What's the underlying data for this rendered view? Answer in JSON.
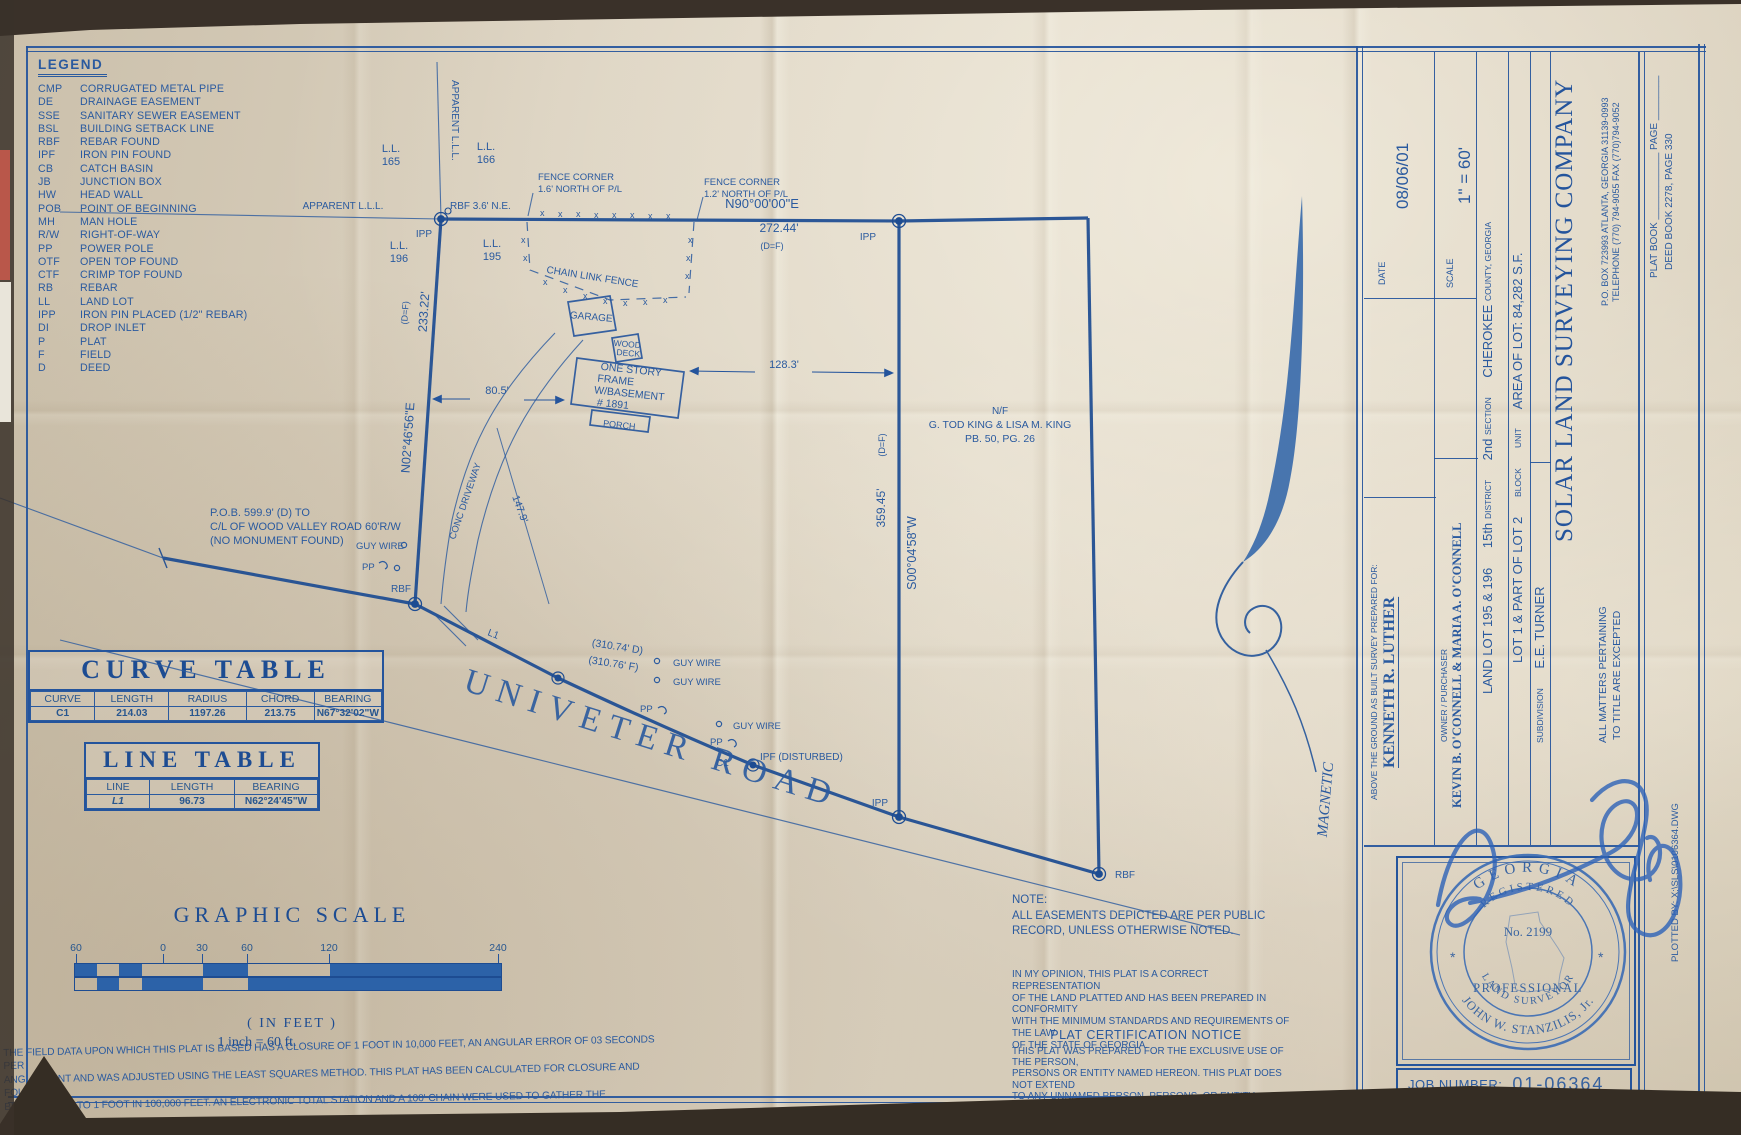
{
  "paper": {
    "ink": "#2a5a9f",
    "ink_dark": "#1d4c92",
    "bg": "#d8cdba"
  },
  "legend": {
    "title": "LEGEND",
    "items": [
      [
        "CMP",
        "CORRUGATED METAL PIPE"
      ],
      [
        "DE",
        "DRAINAGE EASEMENT"
      ],
      [
        "SSE",
        "SANITARY SEWER EASEMENT"
      ],
      [
        "BSL",
        "BUILDING SETBACK LINE"
      ],
      [
        "RBF",
        "REBAR FOUND"
      ],
      [
        "IPF",
        "IRON PIN FOUND"
      ],
      [
        "CB",
        "CATCH BASIN"
      ],
      [
        "JB",
        "JUNCTION BOX"
      ],
      [
        "HW",
        "HEAD WALL"
      ],
      [
        "POB",
        "POINT OF BEGINNING"
      ],
      [
        "MH",
        "MAN HOLE"
      ],
      [
        "R/W",
        "RIGHT-OF-WAY"
      ],
      [
        "PP",
        "POWER POLE"
      ],
      [
        "OTF",
        "OPEN TOP FOUND"
      ],
      [
        "CTF",
        "CRIMP TOP FOUND"
      ],
      [
        "RB",
        "REBAR"
      ],
      [
        "LL",
        "LAND LOT"
      ],
      [
        "IPP",
        "IRON PIN PLACED (1/2\" REBAR)"
      ],
      [
        "DI",
        "DROP INLET"
      ],
      [
        "P",
        "PLAT"
      ],
      [
        "F",
        "FIELD"
      ],
      [
        "D",
        "DEED"
      ]
    ]
  },
  "drawing": {
    "fence_mark": "x",
    "labels": {
      "apparent_lll": "APPARENT L.L.L.",
      "ll": "L.L.",
      "lot165": "165",
      "lot166": "166",
      "lot196": "196",
      "lot195": "195",
      "rbf_ne": "RBF 3.6' N.E.",
      "ipp": "IPP",
      "rbf": "RBF",
      "ipf_disturbed": "IPF (DISTURBED)",
      "fence_corner": "FENCE CORNER",
      "fc1_offset": "1.6' NORTH OF P/L",
      "fc2_offset": "1.2' NORTH OF P/L",
      "bearing_north": "N90°00'00\"E",
      "dist_north": "272.44'",
      "def": "(D=F)",
      "chain_link_fence": "CHAIN LINK FENCE",
      "garage": "GARAGE",
      "wood": "WOOD",
      "deck": "DECK",
      "house1": "ONE STORY",
      "house2": "FRAME",
      "house3": "W/BASEMENT",
      "house4": "# 1891",
      "porch": "PORCH",
      "dim_house_east": "128.3'",
      "dim_house_west": "80.5'",
      "dim_driveway": "147.9'",
      "conc_driveway": "CONC DRIVEWAY",
      "bearing_west": "N02°46'56\"E",
      "dist_west": "233.22'",
      "pob1": "P.O.B. 599.9' (D) TO",
      "pob2": "C/L OF WOOD VALLEY ROAD 60'R/W",
      "pob3": "(NO MONUMENT FOUND)",
      "guy_wire": "GUY WIRE",
      "pp": "PP",
      "l1": "L1",
      "c1": "C1",
      "dist_road_d": "(310.74' D)",
      "dist_road_f": "(310.76' F)",
      "road_name": "UNIVETER ROAD",
      "nf": "N/F",
      "adjoiner": "G. TOD KING & LISA M. KING",
      "adjoiner_ref": "PB. 50, PG. 26",
      "bearing_east": "S00°04'58\"W",
      "dist_east": "359.45'"
    }
  },
  "curve_table": {
    "title": "CURVE TABLE",
    "headers": [
      "CURVE",
      "LENGTH",
      "RADIUS",
      "CHORD",
      "BEARING"
    ],
    "rows": [
      [
        "C1",
        "214.03",
        "1197.26",
        "213.75",
        "N67°32'02\"W"
      ]
    ]
  },
  "line_table": {
    "title": "LINE TABLE",
    "headers": [
      "LINE",
      "LENGTH",
      "BEARING"
    ],
    "rows": [
      [
        "L1",
        "96.73",
        "N62°24'45\"W"
      ]
    ]
  },
  "graphic_scale": {
    "title": "GRAPHIC SCALE",
    "ticks": [
      "60",
      "0",
      "30",
      "60",
      "120",
      "240"
    ],
    "units": "( IN FEET )",
    "ratio": "1 inch = 60  ft."
  },
  "field_note": {
    "lines": [
      "THE FIELD DATA UPON WHICH THIS PLAT IS BASED HAS A CLOSURE OF 1 FOOT IN 10,000 FEET, AN ANGULAR ERROR OF 03 SECONDS PER",
      "ANGLE POINT AND WAS ADJUSTED USING THE LEAST SQUARES METHOD.  THIS PLAT HAS BEEN CALCULATED FOR CLOSURE AND FOUND TO",
      "BE ACCURATE TO 1 FOOT IN 100,000 FEET.  AN ELECTRONIC TOTAL STATION AND A 100' CHAIN WERE USED TO GATHER THE INFORMATION",
      "USED IN THE PREPARATION OF THIS PLAT.  NO STATE PLANE COORDINATE MONUMENT FOUND WITHIN 500' OF THIS PROPERTY."
    ]
  },
  "note": {
    "title": "NOTE:",
    "lines": [
      "ALL EASEMENTS DEPICTED ARE PER PUBLIC",
      "RECORD, UNLESS OTHERWISE NOTED."
    ]
  },
  "opinion": {
    "lines": [
      "IN MY OPINION, THIS PLAT IS A CORRECT REPRESENTATION",
      "OF THE LAND PLATTED AND HAS BEEN PREPARED IN CONFORMITY",
      "WITH THE MINIMUM STANDARDS AND REQUIREMENTS OF THE LAW",
      "OF THE STATE OF GEORGIA."
    ]
  },
  "certification": {
    "title": "PLAT CERTIFICATION NOTICE",
    "lines": [
      "THIS PLAT WAS PREPARED FOR THE EXCLUSIVE USE OF THE PERSON,",
      "PERSONS OR ENTITY NAMED HEREON.  THIS PLAT DOES NOT EXTEND",
      "TO ANY UNNAMED PERSON, PERSONS, OR ENTITY WITHOUT EXPRESS",
      "RECERTIFICATION BY THE SURVEYOR NAMING SAID PERSON, PERSONS,",
      "OR ENTITY."
    ]
  },
  "titleblock": {
    "prepared_label": "ABOVE THE GROUND AS BUILT SURVEY PREPARED FOR:",
    "prepared_name": "KENNETH R. LUTHER",
    "date_label": "DATE",
    "date_value": "08/06/01",
    "owner_label": "OWNER / PURCHASER",
    "owner_value": "KEVIN B. O'CONNELL & MARIA A. O'CONNELL",
    "scale_label": "SCALE",
    "scale_value": "1\" = 60'",
    "land_lot": "LAND LOT 195 & 196",
    "district_value": "15th",
    "district_label": "DISTRICT",
    "section_value": "2nd",
    "section_label": "SECTION",
    "county_value": "CHEROKEE",
    "county_label": "COUNTY, GEORGIA",
    "lot_value": "LOT 1 & PART OF LOT 2",
    "block_label": "BLOCK",
    "unit_label": "UNIT",
    "area_label": "AREA OF LOT: 84,282 S.F.",
    "subdivision_label": "SUBDIVISION",
    "subdivision_value": "E.E. TURNER",
    "company_name": "SOLAR LAND SURVEYING COMPANY",
    "company_addr1": "P.O. BOX 723993   ATLANTA, GEORGIA 31139-0993",
    "company_addr2": "TELEPHONE (770) 794-9055   FAX (770)794-9052",
    "matters1": "ALL MATTERS PERTAINING",
    "matters2": "TO TITLE ARE EXCEPTED",
    "plat_book_line": "PLAT BOOK ____________   PAGE ________",
    "deed_book_line": "DEED BOOK 2278,  PAGE 330",
    "magnetic": "MAGNETIC",
    "job_label": "JOB NUMBER:",
    "job_value": "01-06364",
    "plotted_by": "PLOTTED BY:   X:\\SLS\\0106364.DWG"
  },
  "stamp": {
    "state": "GEORGIA",
    "registered": "REGISTERED",
    "number": "No. 2199",
    "professional": "PROFESSIONAL",
    "land_surveyor": "LAND SURVEYOR",
    "name": "JOHN W. STANZILIS, Jr."
  }
}
